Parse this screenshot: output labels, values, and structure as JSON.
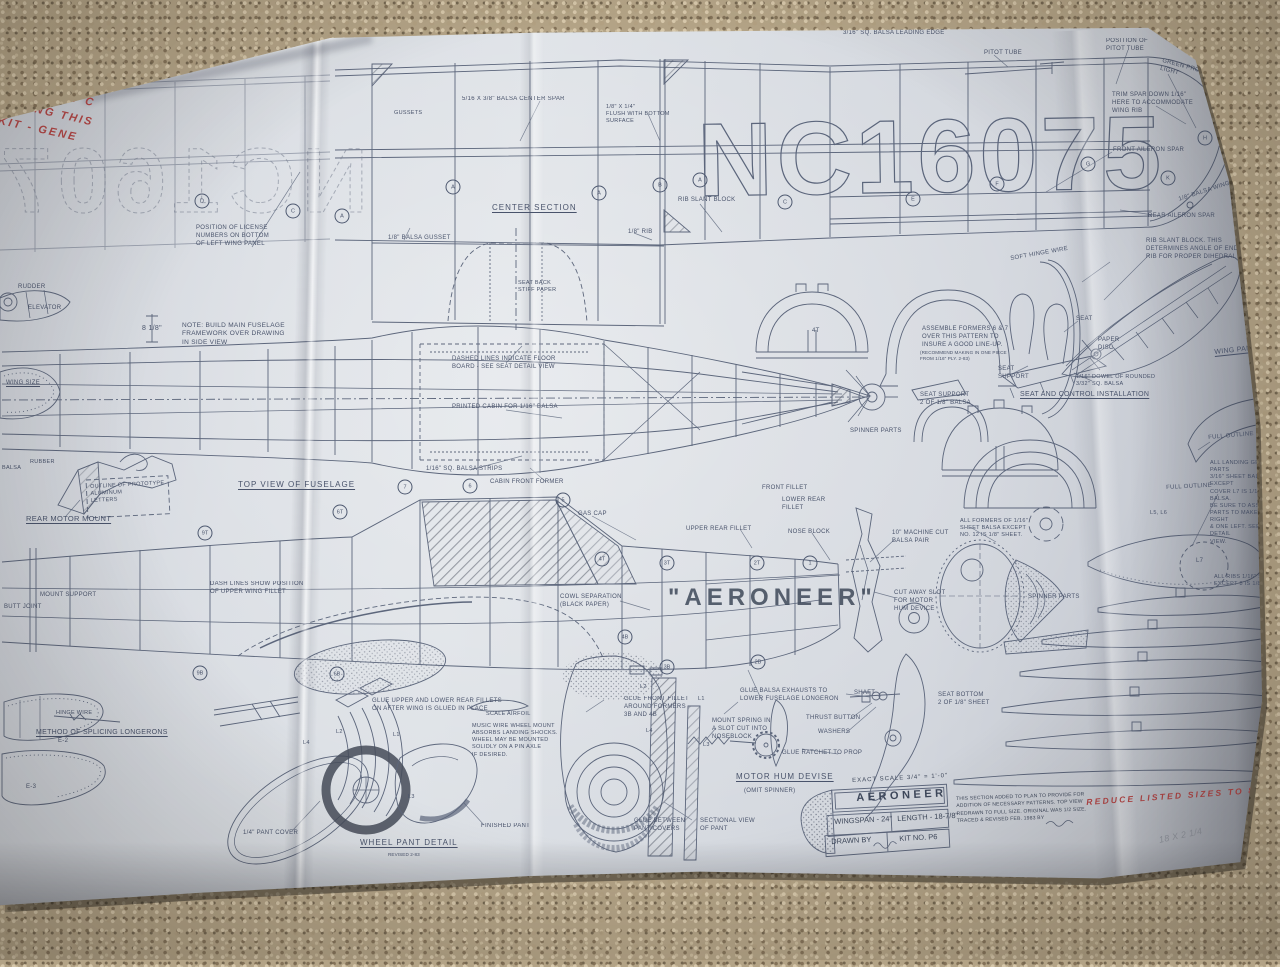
{
  "plan": {
    "registration": "NC16075",
    "sheet_type": "model airplane construction plan",
    "aircraft_name": "AERONEER"
  },
  "title_block": {
    "scale": "EXACT SCALE  3/4\" = 1'-0\"",
    "name": "AERONEER",
    "wingspan": "WINGSPAN - 24\"",
    "length": "LENGTH - 18-7/8\"",
    "drawn_by": "DRAWN BY",
    "kit_no": "KIT NO.  P6",
    "note": "THIS SECTION ADDED TO PLAN TO PROVIDE FOR\nADDITION OF NECESSARY PATTERNS. TOP VIEW\nREDRAWN TO FULL SIZE. ORIGINAL WAS 1/2 SIZE.\nTRACED & REVISED FEB. 1983 BY"
  },
  "colors": {
    "ink": "#4e5970",
    "paper": "#d7dbe1",
    "red_ink": "#b23a3a",
    "carpet": "#b3a386"
  },
  "labels": [
    {
      "t": "BER BAND JOB TO PLAY AROUND WITH",
      "x": 112,
      "y": 14,
      "fs": 13,
      "rot": -2,
      "cls": "red",
      "n": "handwritten-note"
    },
    {
      "t": "BUT GOOD ENOUGH -",
      "x": 112,
      "y": 36,
      "fs": 13,
      "rot": -2,
      "cls": "red",
      "n": "handwritten-note"
    },
    {
      "t": "1/4 SCALE",
      "x": 130,
      "y": 56,
      "fs": 12,
      "rot": -3,
      "cls": "red",
      "n": "handwritten-note"
    },
    {
      "t": "HERE IS A NI",
      "x": 0,
      "y": 58,
      "fs": 11,
      "rot": 10,
      "cls": "red",
      "n": "handwritten-note"
    },
    {
      "t": "NOT EXACT C",
      "x": 0,
      "y": 76,
      "fs": 11,
      "rot": 12,
      "cls": "red",
      "n": "handwritten-note"
    },
    {
      "t": "RAWING THIS",
      "x": 0,
      "y": 94,
      "fs": 11,
      "rot": 13,
      "cls": "red",
      "n": "handwritten-note"
    },
    {
      "t": "KIT -  GENE",
      "x": 0,
      "y": 114,
      "fs": 11,
      "rot": 12,
      "cls": "red",
      "n": "handwritten-note"
    },
    {
      "t": "REDUCE LISTED SIZES TO 83%",
      "x": 1086,
      "y": 797,
      "fs": 8.5,
      "rot": -4,
      "cls": "red",
      "n": "handwritten-note"
    },
    {
      "t": "18 x 2 1/4",
      "x": 1158,
      "y": 835,
      "fs": 9,
      "rot": -12,
      "cls": "pencil",
      "n": "pencil-note"
    },
    {
      "t": "3/16\" SQ. BALSA LEADING EDGE",
      "x": 843,
      "y": 30,
      "fs": 6
    },
    {
      "t": "PITOT TUBE",
      "x": 984,
      "y": 50,
      "fs": 6
    },
    {
      "t": "POSITION OF\nPITOT TUBE",
      "x": 1106,
      "y": 38,
      "fs": 6
    },
    {
      "t": "GREEN PROTECTIVE\nLIGHT",
      "x": 1163,
      "y": 58,
      "fs": 6,
      "rot": 15
    },
    {
      "t": "TRIM SPAR DOWN 1/16\"\nHERE TO ACCOMMODATE\nWING RIB",
      "x": 1112,
      "y": 92,
      "fs": 6
    },
    {
      "t": "FRONT AILERON SPAR",
      "x": 1113,
      "y": 147,
      "fs": 6
    },
    {
      "t": "REAR AILERON SPAR",
      "x": 1148,
      "y": 213,
      "fs": 6
    },
    {
      "t": "1/8\" BALSA WING TIPS",
      "x": 1178,
      "y": 197,
      "fs": 6,
      "rot": -18
    },
    {
      "t": "RIB SLANT BLOCK",
      "x": 678,
      "y": 197,
      "fs": 6
    },
    {
      "t": "GUSSETS",
      "x": 394,
      "y": 110,
      "fs": 5.5
    },
    {
      "t": "5/16 x 3/8\" BALSA CENTER SPAR",
      "x": 462,
      "y": 96,
      "fs": 6
    },
    {
      "t": "1/8\" x 1/4\"\nFLUSH WITH BOTTOM\nSURFACE",
      "x": 606,
      "y": 104,
      "fs": 5.5
    },
    {
      "t": "POSITION OF LICENSE\nNUMBERS ON BOTTOM\nOF LEFT WING PANEL",
      "x": 196,
      "y": 225,
      "fs": 6
    },
    {
      "t": "1/8\" BALSA GUSSET",
      "x": 388,
      "y": 235,
      "fs": 6
    },
    {
      "t": "CENTER SECTION",
      "x": 492,
      "y": 203,
      "fs": 8,
      "u": 1,
      "ls": 1
    },
    {
      "t": "SEAT BACK\nSTIFF PAPER",
      "x": 518,
      "y": 280,
      "fs": 5.5
    },
    {
      "t": "1/8\" RIB",
      "x": 628,
      "y": 229,
      "fs": 6
    },
    {
      "t": "NOTE: BUILD MAIN FUSELAGE\nFRAMEWORK OVER DRAWING\nIN SIDE VIEW",
      "x": 182,
      "y": 322,
      "fs": 6.5
    },
    {
      "t": "8 1/8\"",
      "x": 142,
      "y": 324,
      "fs": 7
    },
    {
      "t": "RUDDER",
      "x": 18,
      "y": 284,
      "fs": 6
    },
    {
      "t": "ELEVATOR",
      "x": 28,
      "y": 305,
      "fs": 6
    },
    {
      "t": "WING SIZE",
      "x": 6,
      "y": 380,
      "fs": 6,
      "u": 1
    },
    {
      "t": "DASHED LINES INDICATE FLOOR\nBOARD - SEE SEAT DETAIL VIEW",
      "x": 452,
      "y": 356,
      "fs": 6
    },
    {
      "t": "PRINTED CABIN FOR 1/16\" BALSA",
      "x": 452,
      "y": 404,
      "fs": 6
    },
    {
      "t": "1/16\" SQ. BALSA STRIPS",
      "x": 426,
      "y": 466,
      "fs": 6
    },
    {
      "t": "TOP VIEW OF FUSELAGE",
      "x": 238,
      "y": 480,
      "fs": 8,
      "u": 1,
      "ls": 1
    },
    {
      "t": "CABIN FRONT FORMER",
      "x": 490,
      "y": 479,
      "fs": 6
    },
    {
      "t": "GAS CAP",
      "x": 578,
      "y": 511,
      "fs": 6
    },
    {
      "t": "RUBBER",
      "x": 30,
      "y": 459,
      "fs": 5.5
    },
    {
      "t": "BALSA",
      "x": 2,
      "y": 465,
      "fs": 5.5
    },
    {
      "t": "OUTLINE OF PROTOTYPE\nALUMINUM\nLETTERS",
      "x": 90,
      "y": 484,
      "fs": 5.5,
      "rot": -3
    },
    {
      "t": "REAR MOTOR MOUNT",
      "x": 26,
      "y": 514,
      "fs": 7.5,
      "u": 1
    },
    {
      "t": "MOUNT SUPPORT",
      "x": 40,
      "y": 592,
      "fs": 6
    },
    {
      "t": "BUTT JOINT",
      "x": 4,
      "y": 604,
      "fs": 6
    },
    {
      "t": "DASH LINES SHOW POSITION\nOF UPPER WING FILLET",
      "x": 210,
      "y": 581,
      "fs": 6
    },
    {
      "t": "UPPER REAR FILLET",
      "x": 686,
      "y": 526,
      "fs": 6
    },
    {
      "t": "FRONT FILLET",
      "x": 762,
      "y": 485,
      "fs": 6
    },
    {
      "t": "LOWER REAR\nFILLET",
      "x": 782,
      "y": 497,
      "fs": 6
    },
    {
      "t": "NOSE BLOCK",
      "x": 788,
      "y": 529,
      "fs": 6
    },
    {
      "t": "10\" MACHINE CUT\nBALSA PAIR",
      "x": 892,
      "y": 530,
      "fs": 6
    },
    {
      "t": "CUT AWAY SLOT\nFOR MOTOR\nHUM DEVICE",
      "x": 894,
      "y": 590,
      "fs": 6
    },
    {
      "t": "COWL SEPARATION\n(BLACK PAPER)",
      "x": 560,
      "y": 594,
      "fs": 6
    },
    {
      "t": "\"AERONEER\"",
      "x": 668,
      "y": 582,
      "cls": "big",
      "n": "aircraft-name"
    },
    {
      "t": "GLUE UPPER AND LOWER REAR FILLETS\nON AFTER WING IS GLUED IN PLACE",
      "x": 372,
      "y": 698,
      "fs": 6
    },
    {
      "t": "SCALE AIRFOIL",
      "x": 486,
      "y": 711,
      "fs": 5.5
    },
    {
      "t": "MUSIC WIRE WHEEL MOUNT\nABSORBS LANDING SHOCKS.\nWHEEL MAY BE MOUNTED\nSOLIDLY ON A PIN AXLE\nIF DESIRED.",
      "x": 472,
      "y": 723,
      "fs": 5.5
    },
    {
      "t": "METHOD OF SPLICING LONGERONS",
      "x": 36,
      "y": 728,
      "fs": 7,
      "u": 1
    },
    {
      "t": "HINGE WIRE",
      "x": 56,
      "y": 710,
      "fs": 5.5
    },
    {
      "t": "1/4\" PANT COVER",
      "x": 243,
      "y": 830,
      "fs": 6
    },
    {
      "t": "FINISHED PANT",
      "x": 481,
      "y": 823,
      "fs": 6
    },
    {
      "t": "WHEEL PANT DETAIL",
      "x": 360,
      "y": 838,
      "fs": 8,
      "u": 1,
      "ls": 1
    },
    {
      "t": "REVISED 2-83",
      "x": 388,
      "y": 852,
      "cls": "tiny"
    },
    {
      "t": "GLUE FRONT FILLET\nAROUND FORMERS\n3B AND 4B",
      "x": 624,
      "y": 696,
      "fs": 6
    },
    {
      "t": "GLUE BALSA EXHAUSTS TO\nLOWER FUSELAGE LONGERON",
      "x": 740,
      "y": 688,
      "fs": 6
    },
    {
      "t": "MOUNT SPRING IN\nA SLOT CUT INTO\nNOSEBLOCK",
      "x": 712,
      "y": 718,
      "fs": 6
    },
    {
      "t": "GLUE RATCHET TO PROP",
      "x": 782,
      "y": 750,
      "fs": 6
    },
    {
      "t": "MOTOR HUM DEVISE",
      "x": 736,
      "y": 772,
      "fs": 8,
      "u": 1,
      "ls": 1
    },
    {
      "t": "(OMIT SPINNER)",
      "x": 744,
      "y": 788,
      "fs": 6
    },
    {
      "t": "SHAFT",
      "x": 854,
      "y": 690,
      "fs": 6
    },
    {
      "t": "THRUST BUTTON",
      "x": 806,
      "y": 715,
      "fs": 6
    },
    {
      "t": "WASHERS",
      "x": 818,
      "y": 729,
      "fs": 6
    },
    {
      "t": "GLUE BETWEEN\nPANT COVERS",
      "x": 634,
      "y": 818,
      "fs": 6
    },
    {
      "t": "SECTIONAL VIEW\nOF PANT",
      "x": 700,
      "y": 818,
      "fs": 6
    },
    {
      "t": "ASSEMBLE FORMERS 6 & 7\nOVER THIS PATTERN TO\nINSURE A GOOD LINE-UP.",
      "x": 922,
      "y": 326,
      "fs": 6
    },
    {
      "t": "(RECOMMEND MAKING IN ONE PIECE\nFROM 1/16\" PLY. 2-83)",
      "x": 920,
      "y": 350,
      "cls": "tiny"
    },
    {
      "t": "SEAT SUPPORT\n2 OF 1/8\" BALSA",
      "x": 920,
      "y": 392,
      "fs": 6
    },
    {
      "t": "SPINNER PARTS",
      "x": 850,
      "y": 428,
      "fs": 6
    },
    {
      "t": "SEAT",
      "x": 1076,
      "y": 316,
      "fs": 6
    },
    {
      "t": "PAPER\nDISC",
      "x": 1098,
      "y": 337,
      "fs": 6
    },
    {
      "t": "SEAT\nSUPPORT",
      "x": 998,
      "y": 366,
      "fs": 6
    },
    {
      "t": "1/16\" DOWEL OF ROUNDED\n3/32\" SQ. BALSA",
      "x": 1076,
      "y": 374,
      "fs": 5.5
    },
    {
      "t": "SEAT AND CONTROL INSTALLATION",
      "x": 1020,
      "y": 390,
      "fs": 7,
      "u": 1
    },
    {
      "t": "SOFT HINGE WIRE",
      "x": 1010,
      "y": 256,
      "fs": 6,
      "rot": -10
    },
    {
      "t": "RIB SLANT BLOCK. THIS\nDETERMINES ANGLE OF END\nRIB FOR PROPER DIHEDRAL",
      "x": 1146,
      "y": 238,
      "fs": 6
    },
    {
      "t": "WING PANEL",
      "x": 1214,
      "y": 348,
      "fs": 7,
      "u": 1,
      "rot": -6
    },
    {
      "t": "ALL FORMERS OF 1/16\"\nSHEET BALSA EXCEPT\nNO. 12 IS 1/8\" SHEET.",
      "x": 960,
      "y": 518,
      "fs": 5.5
    },
    {
      "t": "SPINNER PARTS",
      "x": 1028,
      "y": 594,
      "fs": 6
    },
    {
      "t": "FULL OUTLINE",
      "x": 1208,
      "y": 435,
      "fs": 6,
      "rot": -5
    },
    {
      "t": "FULL OUTLINE",
      "x": 1166,
      "y": 485,
      "fs": 6,
      "rot": -3
    },
    {
      "t": "ALL LANDING GEAR PARTS\n3/16\" SHEET BALSA EXCEPT\nCOVER L7 IS 1/16\" BALSA.\nBE SURE TO ASSEMBLE\nPARTS TO MAKE ONE RIGHT\n& ONE LEFT. SEE DETAIL\nVIEW.",
      "x": 1210,
      "y": 460,
      "fs": 5.5
    },
    {
      "t": "ALL RIBS 1/16\" SHEET\nEXCEPT 8 IS 1/8\"",
      "x": 1214,
      "y": 574,
      "fs": 5.5
    },
    {
      "t": "L5, L6",
      "x": 1150,
      "y": 510,
      "fs": 5.5
    },
    {
      "t": "L7",
      "x": 1196,
      "y": 558,
      "fs": 6
    },
    {
      "t": "SEAT BOTTOM\n2 OF 1/8\" SHEET",
      "x": 938,
      "y": 692,
      "fs": 6
    },
    {
      "t": "L2",
      "x": 336,
      "y": 729,
      "fs": 5.5
    },
    {
      "t": "L1",
      "x": 393,
      "y": 732,
      "fs": 5.5
    },
    {
      "t": "L4",
      "x": 303,
      "y": 740,
      "fs": 5.5
    },
    {
      "t": "L3",
      "x": 408,
      "y": 794,
      "fs": 5.5
    },
    {
      "t": "L2",
      "x": 640,
      "y": 684,
      "fs": 5.5
    },
    {
      "t": "L1",
      "x": 698,
      "y": 696,
      "fs": 5.5
    },
    {
      "t": "L4",
      "x": 646,
      "y": 728,
      "fs": 5.5
    },
    {
      "t": "L3",
      "x": 703,
      "y": 742,
      "fs": 5.5
    },
    {
      "t": "E-2",
      "x": 58,
      "y": 738,
      "fs": 6
    },
    {
      "t": "E-3",
      "x": 26,
      "y": 784,
      "fs": 6
    },
    {
      "t": "4T",
      "x": 812,
      "y": 328,
      "fs": 6
    }
  ],
  "circles": [
    {
      "t": "D",
      "x": 202,
      "y": 201
    },
    {
      "t": "C",
      "x": 293,
      "y": 211
    },
    {
      "t": "A",
      "x": 342,
      "y": 216
    },
    {
      "t": "A",
      "x": 453,
      "y": 187
    },
    {
      "t": "A",
      "x": 599,
      "y": 193
    },
    {
      "t": "B",
      "x": 660,
      "y": 185
    },
    {
      "t": "A",
      "x": 700,
      "y": 180
    },
    {
      "t": "C",
      "x": 785,
      "y": 202
    },
    {
      "t": "E",
      "x": 913,
      "y": 199
    },
    {
      "t": "F",
      "x": 997,
      "y": 184
    },
    {
      "t": "G",
      "x": 1088,
      "y": 164
    },
    {
      "t": "H",
      "x": 1205,
      "y": 138
    },
    {
      "t": "K",
      "x": 1168,
      "y": 178
    },
    {
      "t": "7",
      "x": 405,
      "y": 487
    },
    {
      "t": "6",
      "x": 470,
      "y": 486
    },
    {
      "t": "5",
      "x": 563,
      "y": 500
    },
    {
      "t": "6T",
      "x": 340,
      "y": 512
    },
    {
      "t": "9T",
      "x": 205,
      "y": 533
    },
    {
      "t": "4T",
      "x": 602,
      "y": 559
    },
    {
      "t": "3T",
      "x": 667,
      "y": 563
    },
    {
      "t": "2T",
      "x": 757,
      "y": 563
    },
    {
      "t": "1",
      "x": 810,
      "y": 563
    },
    {
      "t": "4B",
      "x": 625,
      "y": 637
    },
    {
      "t": "9B",
      "x": 200,
      "y": 673
    },
    {
      "t": "6B",
      "x": 337,
      "y": 674
    },
    {
      "t": "2B",
      "x": 758,
      "y": 662
    },
    {
      "t": "3B",
      "x": 667,
      "y": 667
    }
  ]
}
